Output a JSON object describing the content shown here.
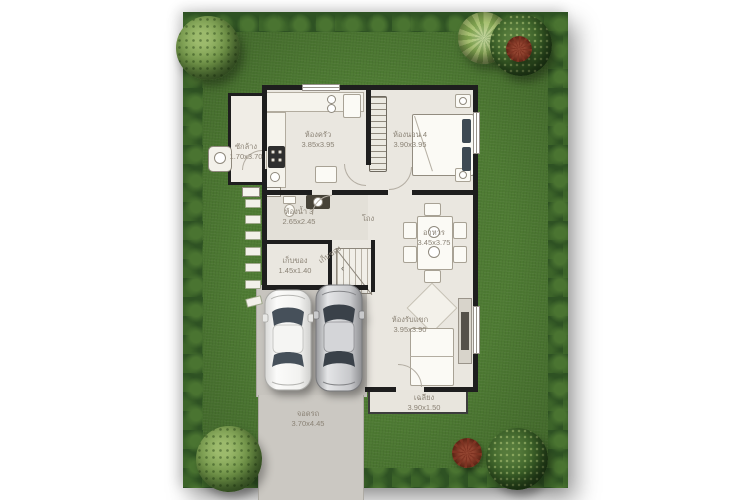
{
  "plan": {
    "rooms": {
      "laundry": {
        "name": "ซักล้าง",
        "dims": "1.70x3.70"
      },
      "kitchen": {
        "name": "ห้องครัว",
        "dims": "3.85x3.95"
      },
      "bedroom4": {
        "name": "ห้องนอน 4",
        "dims": "3.90x3.95"
      },
      "bathroom3": {
        "name": "ห้องน้ำ 3",
        "dims": "2.65x2.45"
      },
      "storage": {
        "name": "เก็บของ",
        "dims": "1.45x1.40"
      },
      "under_stairs": {
        "name": "เก็บของ"
      },
      "hall": {
        "name": "โถง"
      },
      "dining": {
        "name": "อาหาร",
        "dims": "3.45x3.75"
      },
      "living": {
        "name": "ห้องรับแขก",
        "dims": "3.95x3.90"
      },
      "porch": {
        "name": "เฉลียง",
        "dims": "3.90x1.50"
      },
      "carport": {
        "name": "จอดรถ",
        "dims": "3.70x4.45"
      }
    },
    "icons": {
      "stair_arrow": "‹"
    },
    "colors": {
      "grass": "#4e7b33",
      "hedge": "#2e5223",
      "floor": "#eae7e0",
      "concrete": "#c7c4be",
      "wall": "#1e1e1e",
      "label": "#8b8376"
    }
  }
}
